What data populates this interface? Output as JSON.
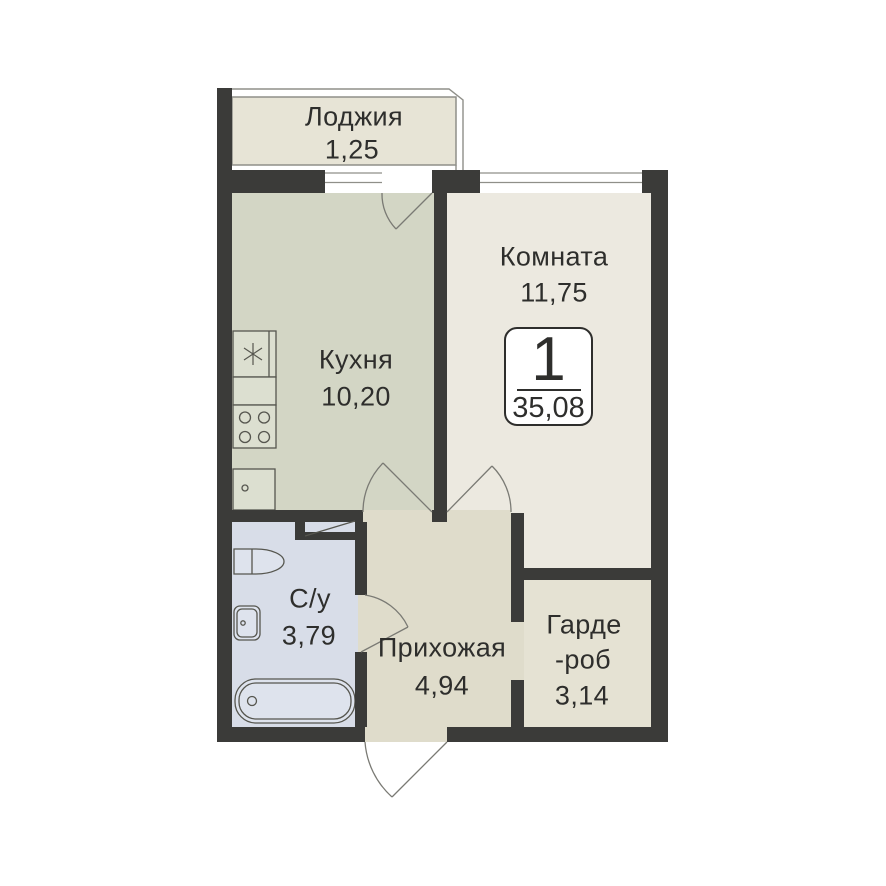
{
  "plan": {
    "badge": {
      "number": "1",
      "total_area": "35,08"
    },
    "rooms": {
      "loggia": {
        "name": "Лоджия",
        "area": "1,25"
      },
      "room": {
        "name": "Комната",
        "area": "11,75"
      },
      "kitchen": {
        "name": "Кухня",
        "area": "10,20"
      },
      "bathroom": {
        "name": "С/у",
        "area": "3,79"
      },
      "hallway": {
        "name": "Прихожая",
        "area": "4,94"
      },
      "wardrobe": {
        "name_line1": "Гарде",
        "name_line2": "-роб",
        "area": "3,14"
      }
    },
    "colors": {
      "wall": "#3B3B39",
      "loggia_fill": "#E7E4D6",
      "kitchen_fill": "#D3D6C5",
      "room_fill": "#ECE9E0",
      "hallway_fill": "#DFDCCB",
      "wardrobe_fill": "#E5E2D3",
      "bathroom_fill": "#D8DDE8",
      "fixture_kitchen_fill": "#DCDFD0",
      "fixture_bath_fill": "#DEE3ED",
      "door_arc": "#7A7A74",
      "window_line": "#8F8F89",
      "text": "#2E2E2C",
      "background": "#FFFFFF"
    }
  }
}
